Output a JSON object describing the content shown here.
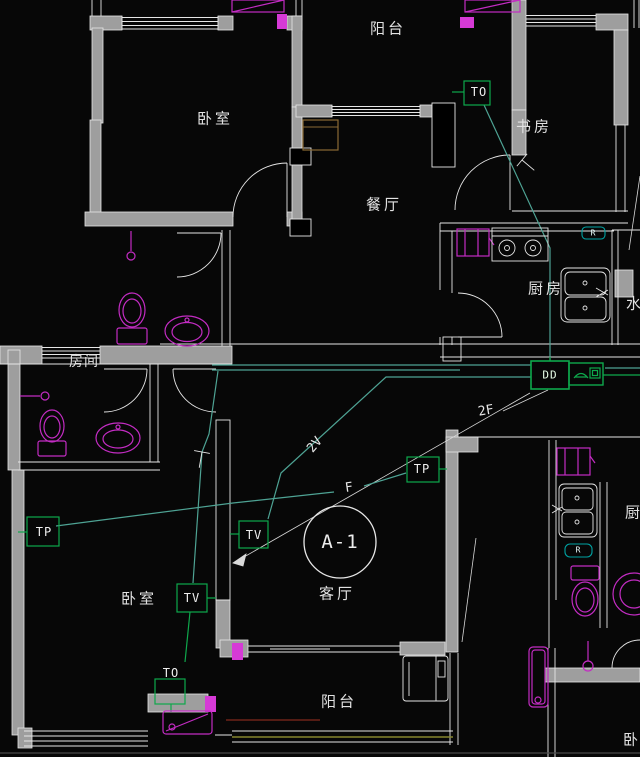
{
  "drawing": {
    "unit_circle_label": "A-1",
    "rooms": {
      "balcony_top": "阳台",
      "bedroom_top_left": "卧室",
      "study": "书房",
      "dining": "餐厅",
      "kitchen": "厨房",
      "water_clipped": "水",
      "room_small": "房间",
      "living": "客厅",
      "bedroom_bottom_left": "卧室",
      "balcony_bottom": "阳台",
      "kitchen_right_clipped": "厨",
      "bedroom_right_clipped": "卧"
    },
    "sockets": {
      "study_to": "TO",
      "living_tp": "TP",
      "living_tv": "TV",
      "bedroom_tp": "TP",
      "bedroom_tv": "TV",
      "bedroom_to": "TO",
      "distribution_box": "DD",
      "kitchen_r_badge": "R",
      "right_unit_r_badge": "R"
    },
    "wire_tags": {
      "phone_riser": "2F",
      "tv_run": "2V",
      "phone_run": "F"
    },
    "colors": {
      "background": "#070707",
      "wall_fill": "#9e9e9e",
      "line_white": "#e6e6e6",
      "fixture_magenta": "#c32cc3",
      "socket_green": "#0ea84c",
      "wire_teal": "#4ea394",
      "badge_teal": "#00a3a3",
      "cabinet_brown": "#8a6a34",
      "sill_olive": "#85852f",
      "sill_darkred": "#6e2418"
    }
  }
}
